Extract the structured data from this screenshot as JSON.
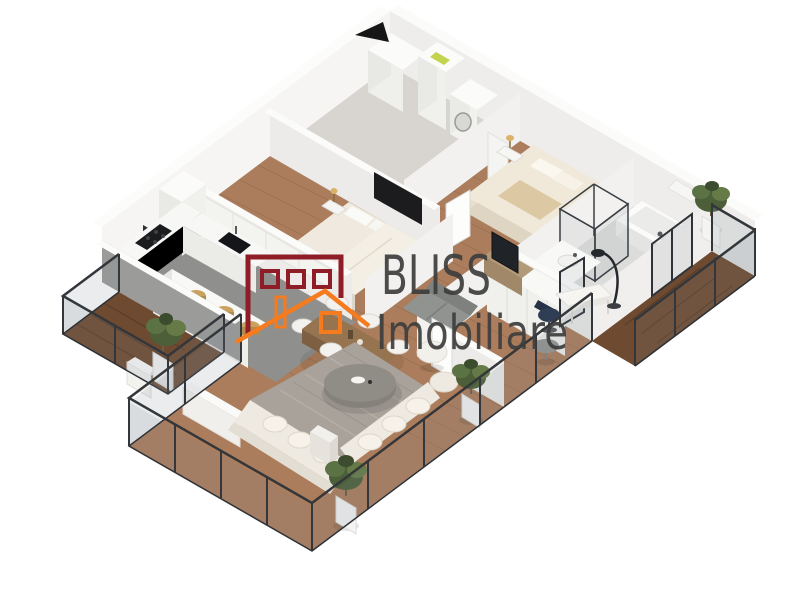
{
  "watermark": {
    "brand_line1": "BLISS",
    "brand_line2": "Imobiliare",
    "text_color": "#3d3d3d",
    "logo": {
      "building_color": "#8e1d28",
      "roof_color": "#f57b1e"
    }
  },
  "compass": {
    "icon": "north-arrow",
    "color": "#161616"
  },
  "scene": {
    "type": "isometric-3d-apartment-floor-plan",
    "background": "#ffffff",
    "palette": {
      "wood_floor": "#ab7d5c",
      "balcony_wood": "#6e4a30",
      "kitchen_floor": "#8f8f8d",
      "bathroom_floor": "#dcdcda",
      "entry_floor": "#d8d4cf",
      "wall_lit": "#f6f5f3",
      "wall_shaded": "#ecebe9",
      "railing_frame": "#33373b",
      "rug": "#a8a29a",
      "sofa": "#eeeae1",
      "plant_green": "#55683f",
      "stool_tan": "#c9a25e"
    }
  }
}
